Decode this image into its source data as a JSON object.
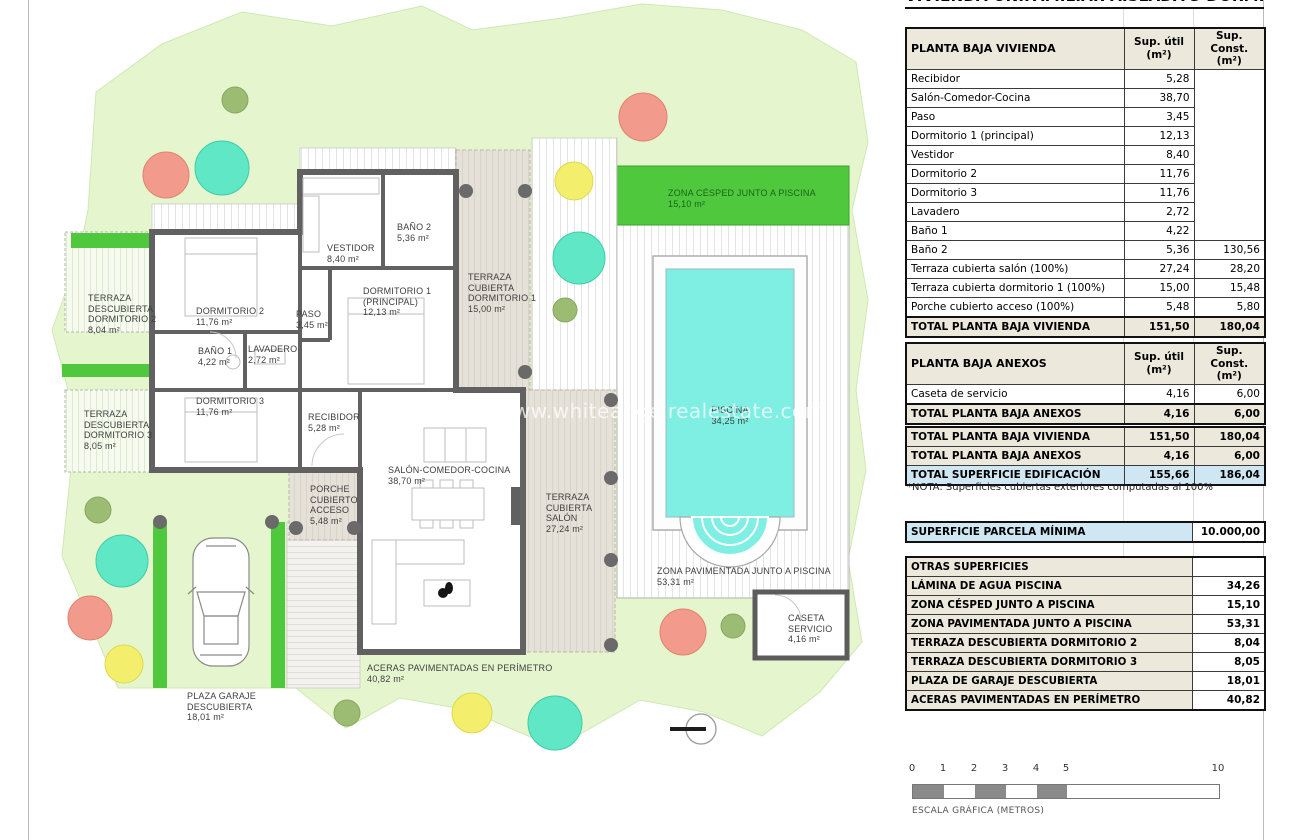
{
  "watermark": "www.whiteangelrealestate.com",
  "title": "VIVIENDA UNIFAMILIAR AISLADA 3 DORMITORIOS",
  "columns": {
    "util": "Sup. útil\n(m²)",
    "const": "Sup. Const.\n(m²)"
  },
  "vivienda": {
    "header": "PLANTA BAJA VIVIENDA",
    "rows": [
      {
        "label": "Recibidor",
        "util": "5,28",
        "const": ""
      },
      {
        "label": "Salón-Comedor-Cocina",
        "util": "38,70",
        "const": ""
      },
      {
        "label": "Paso",
        "util": "3,45",
        "const": ""
      },
      {
        "label": "Dormitorio 1 (principal)",
        "util": "12,13",
        "const": ""
      },
      {
        "label": "Vestidor",
        "util": "8,40",
        "const": ""
      },
      {
        "label": "Dormitorio 2",
        "util": "11,76",
        "const": ""
      },
      {
        "label": "Dormitorio 3",
        "util": "11,76",
        "const": ""
      },
      {
        "label": "Lavadero",
        "util": "2,72",
        "const": ""
      },
      {
        "label": "Baño 1",
        "util": "4,22",
        "const": ""
      },
      {
        "label": "Baño 2",
        "util": "5,36",
        "const": "130,56"
      },
      {
        "label": "Terraza cubierta salón (100%)",
        "util": "27,24",
        "const": "28,20"
      },
      {
        "label": "Terraza cubierta dormitorio 1 (100%)",
        "util": "15,00",
        "const": "15,48"
      },
      {
        "label": "Porche cubierto acceso (100%)",
        "util": "5,48",
        "const": "5,80"
      }
    ],
    "total": {
      "label": "TOTAL PLANTA BAJA VIVIENDA",
      "util": "151,50",
      "const": "180,04"
    }
  },
  "anexos": {
    "header": "PLANTA BAJA ANEXOS",
    "rows": [
      {
        "label": "Caseta de servicio",
        "util": "4,16",
        "const": "6,00"
      }
    ],
    "total": {
      "label": "TOTAL PLANTA BAJA ANEXOS",
      "util": "4,16",
      "const": "6,00"
    }
  },
  "summary": {
    "rows": [
      {
        "label": "TOTAL PLANTA BAJA VIVIENDA",
        "util": "151,50",
        "const": "180,04",
        "hl": false
      },
      {
        "label": "TOTAL PLANTA BAJA ANEXOS",
        "util": "4,16",
        "const": "6,00",
        "hl": false
      },
      {
        "label": "TOTAL SUPERFICIE EDIFICACIÓN",
        "util": "155,66",
        "const": "186,04",
        "hl": true
      }
    ],
    "note": "*NOTA: Superficies cubiertas exteriores computadas al 100%"
  },
  "parcela": {
    "label": "SUPERFICIE PARCELA MÍNIMA",
    "value": "10.000,00"
  },
  "otras": {
    "header": "OTRAS SUPERFICIES",
    "rows": [
      {
        "label": "LÁMINA DE AGUA PISCINA",
        "value": "34,26"
      },
      {
        "label": "ZONA CÉSPED JUNTO A PISCINA",
        "value": "15,10"
      },
      {
        "label": "ZONA PAVIMENTADA JUNTO A PISCINA",
        "value": "53,31"
      },
      {
        "label": "TERRAZA DESCUBIERTA DORMITORIO 2",
        "value": "8,04"
      },
      {
        "label": "TERRAZA DESCUBIERTA DORMITORIO 3",
        "value": "8,05"
      },
      {
        "label": "PLAZA DE GARAJE DESCUBIERTA",
        "value": "18,01"
      },
      {
        "label": "ACERAS PAVIMENTADAS EN PERÍMETRO",
        "value": "40,82"
      }
    ]
  },
  "scalebar": {
    "ticks": [
      "0",
      "1",
      "2",
      "3",
      "4",
      "5",
      "10"
    ],
    "label": "ESCALA GRÁFICA (METROS)"
  },
  "plan": {
    "labels": [
      {
        "name": "TERRAZA\nDESCUBIERTA\nDORMITORIO 2",
        "area": "8,04 m²"
      },
      {
        "name": "DORMITORIO 2",
        "area": "11,76 m²"
      },
      {
        "name": "VESTIDOR",
        "area": "8,40 m²"
      },
      {
        "name": "BAÑO 2",
        "area": "5,36 m²"
      },
      {
        "name": "PASO",
        "area": "3,45 m²"
      },
      {
        "name": "DORMITORIO 1\n(PRINCIPAL)",
        "area": "12,13 m²"
      },
      {
        "name": "TERRAZA\nCUBIERTA\nDORMITORIO 1",
        "area": "15,00 m²"
      },
      {
        "name": "BAÑO 1",
        "area": "4,22 m²"
      },
      {
        "name": "LAVADERO",
        "area": "2,72 m²"
      },
      {
        "name": "DORMITORIO 3",
        "area": "11,76 m²"
      },
      {
        "name": "TERRAZA\nDESCUBIERTA\nDORMITORIO 3",
        "area": "8,05 m²"
      },
      {
        "name": "RECIBIDOR",
        "area": "5,28 m²"
      },
      {
        "name": "SALÓN-COMEDOR-COCINA",
        "area": "38,70 m²"
      },
      {
        "name": "PORCHE\nCUBIERTO\nACCESO",
        "area": "5,48 m²"
      },
      {
        "name": "TERRAZA\nCUBIERTA\nSALÓN",
        "area": "27,24 m²"
      },
      {
        "name": "ZONA CÉSPED JUNTO A PISCINA",
        "area": "15,10 m²"
      },
      {
        "name": "PISCINA",
        "area": "34,25 m²"
      },
      {
        "name": "ZONA PAVIMENTADA JUNTO A PISCINA",
        "area": "53,31 m²"
      },
      {
        "name": "CASETA\nSERVICIO",
        "area": "4,16 m²"
      },
      {
        "name": "ACERAS PAVIMENTADAS EN PERÍMETRO",
        "area": "40,82 m²"
      },
      {
        "name": "PLAZA GARAJE\nDESCUBIERTA",
        "area": "18,01 m²"
      }
    ]
  },
  "colors": {
    "lawn": "#e5f6cf",
    "grass_band": "#50c83d",
    "pool_water": "#7feee3",
    "wall": "#616161",
    "table_header": "#ece9dc",
    "highlight_blue": "#cfe7f3",
    "tree_teal": "#5fe7c6",
    "tree_salmon": "#f29a8c",
    "tree_yellow": "#f3ef6d",
    "tree_olive": "#9cbc74"
  }
}
